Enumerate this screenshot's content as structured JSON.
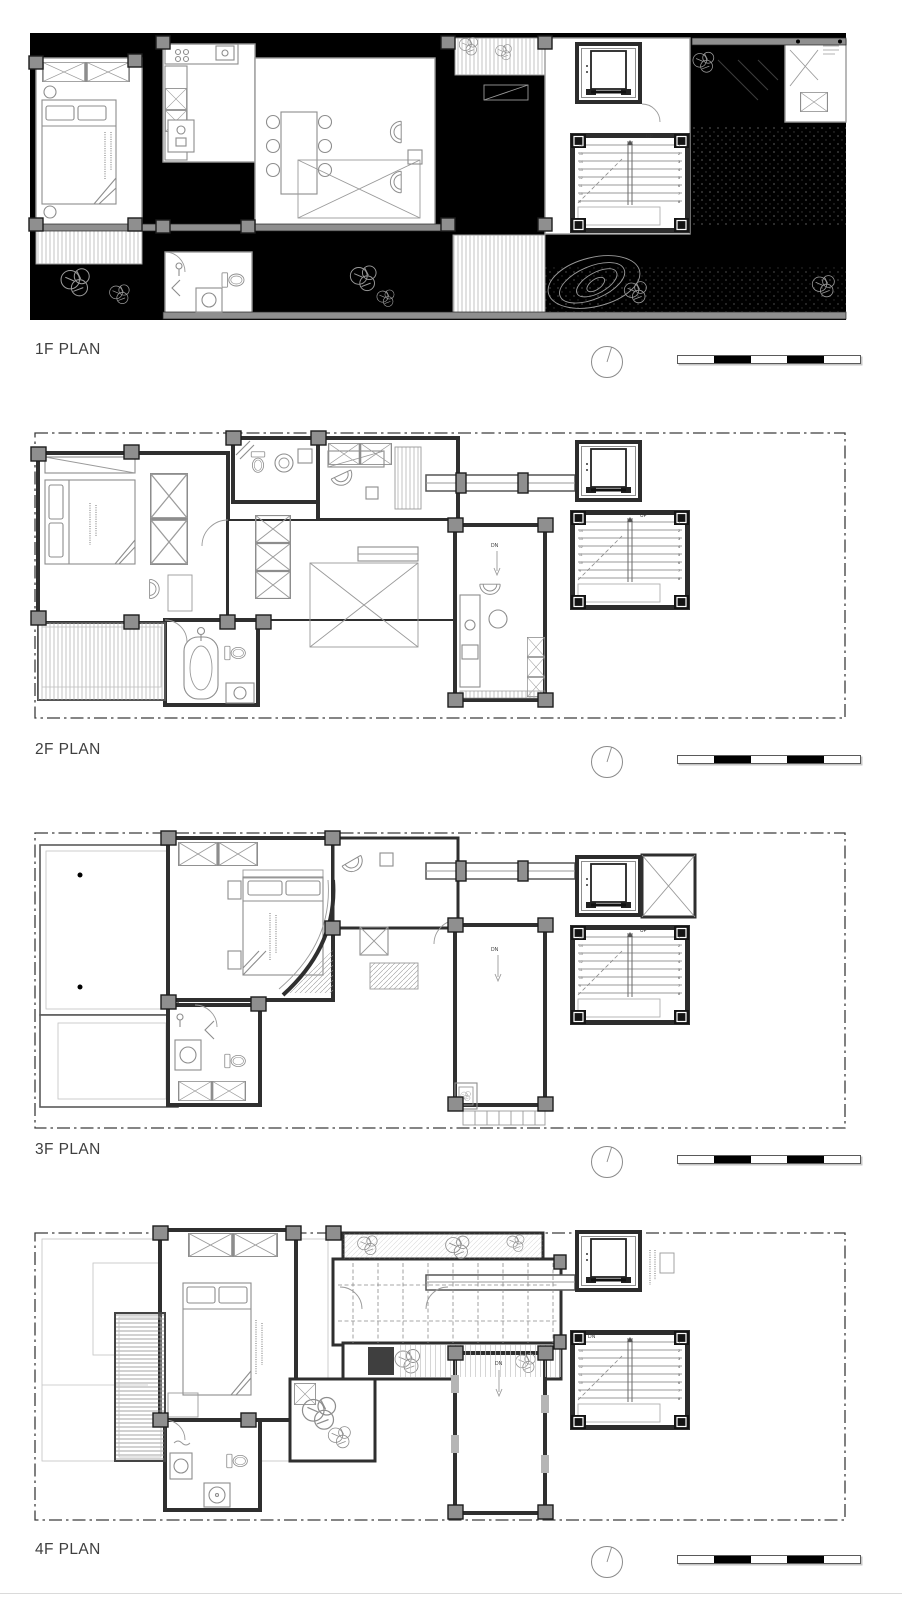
{
  "document": {
    "type": "architectural-floor-plan-sheet",
    "background": "#ffffff"
  },
  "colors": {
    "site_poche_black": "#000000",
    "wall_dark": "#2f2f2f",
    "column_gray": "#8f8f8f",
    "furniture_gray": "#8d8d8d",
    "label_text": "#3f3f3f",
    "property_line": "#3c3c3c"
  },
  "floors": [
    {
      "id": "1f",
      "label": "1F PLAN",
      "stair_dir": "UP",
      "right_nums": [
        "1",
        "2",
        "3",
        "4",
        "5",
        "6",
        "7",
        "8"
      ],
      "left_nums": [
        "16",
        "15",
        "14",
        "13",
        "12",
        "11",
        "10",
        "9"
      ]
    },
    {
      "id": "2f",
      "label": "2F PLAN",
      "stair_dir": "UP",
      "void_dn": "DN",
      "right_nums": [
        "1",
        "2",
        "3",
        "4",
        "5",
        "6",
        "7",
        "8"
      ],
      "left_nums": [
        "15",
        "14",
        "13",
        "12",
        "11",
        "10",
        "9"
      ]
    },
    {
      "id": "3f",
      "label": "3F PLAN",
      "stair_dir": "UP",
      "void_dn": "DN",
      "right_nums": [
        "1",
        "2",
        "3",
        "4",
        "5",
        "6",
        "7",
        "8"
      ],
      "left_nums": [
        "15",
        "14",
        "13",
        "12",
        "11",
        "10",
        "9"
      ]
    },
    {
      "id": "4f",
      "label": "4F PLAN",
      "stair_dir": "DN",
      "void_dn": "DN",
      "right_nums": [
        "1",
        "2",
        "3",
        "4",
        "5",
        "6",
        "7",
        "8"
      ],
      "left_nums": [
        "15",
        "14",
        "13",
        "12",
        "11",
        "10",
        "9"
      ]
    }
  ],
  "annotations": {
    "north_marker": "north-indicator-circle",
    "scale_bar_pattern": [
      "white",
      "black",
      "white",
      "black",
      "white"
    ]
  }
}
